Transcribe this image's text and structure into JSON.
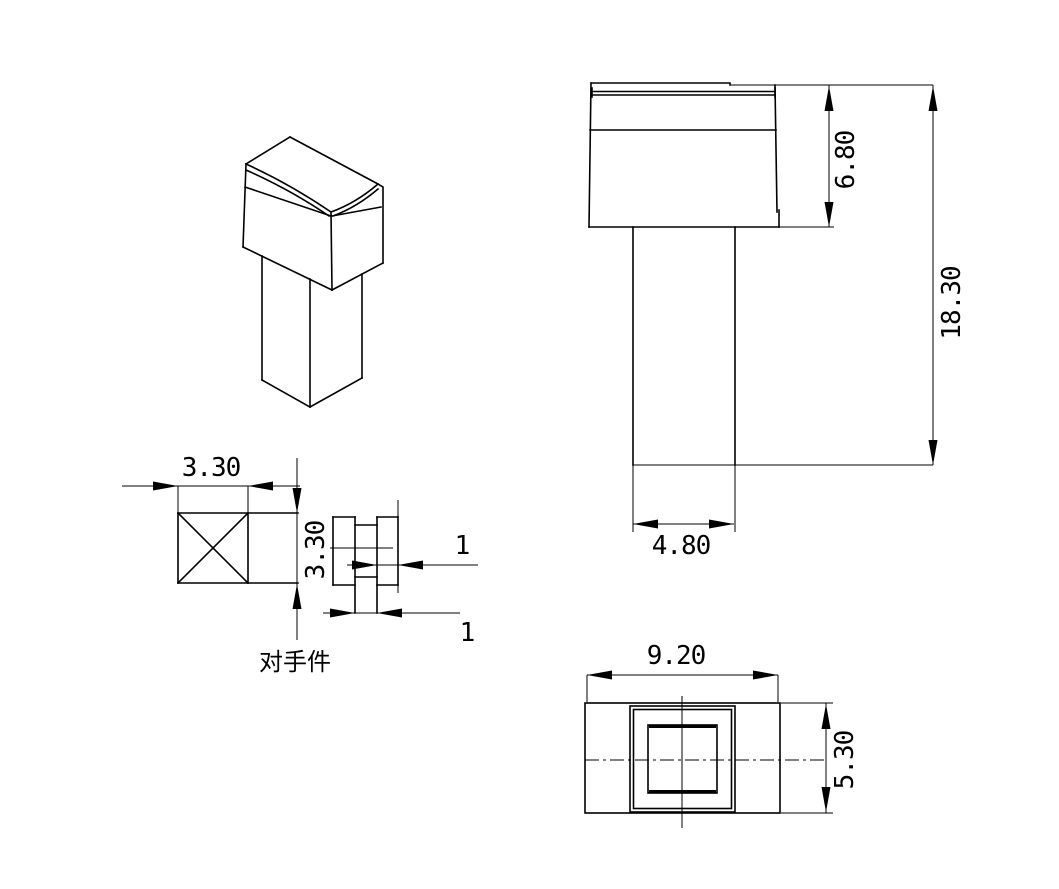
{
  "drawing": {
    "colors": {
      "line": "#000000",
      "background": "#ffffff"
    },
    "front_view": {
      "dim_head_height": "6.80",
      "dim_total_height": "18.30",
      "dim_shaft_width": "4.80"
    },
    "section_view": {
      "dim_width": "3.30",
      "dim_height": "3.30",
      "dim_rib_width": "1",
      "dim_stem_width": "1",
      "label_mating_part": "对手件"
    },
    "top_view": {
      "dim_width": "9.20",
      "dim_depth": "5.30"
    }
  }
}
